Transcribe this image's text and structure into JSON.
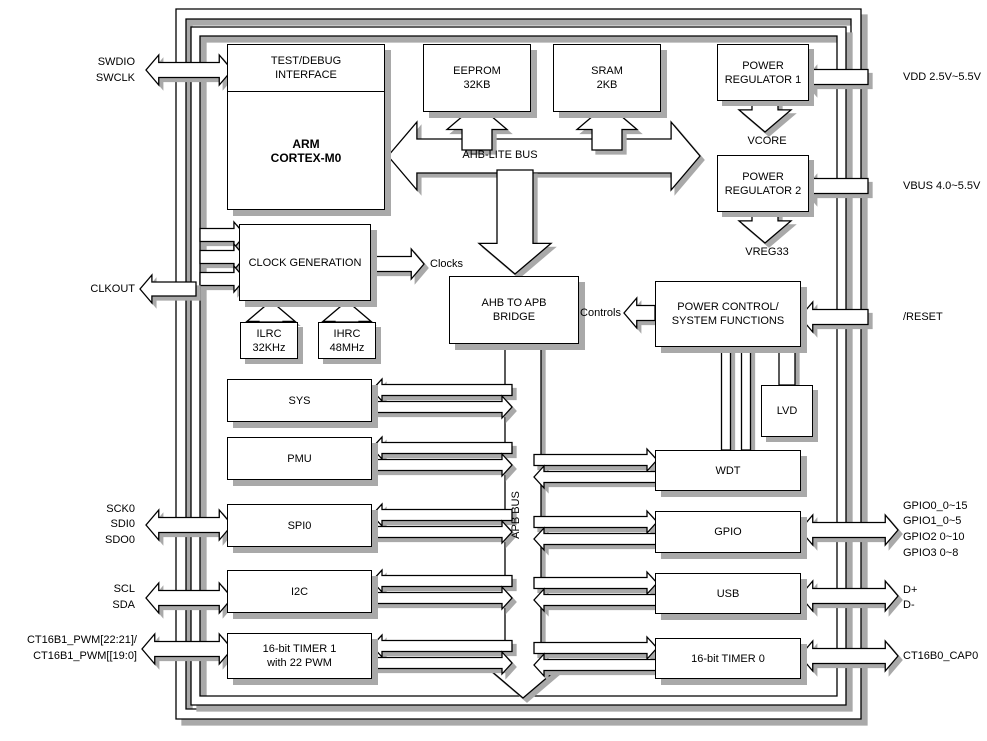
{
  "chip": {
    "blocks": {
      "test_debug": "TEST/DEBUG\nINTERFACE",
      "arm_core": "ARM\nCORTEX-M0",
      "eeprom": "EEPROM\n32KB",
      "sram": "SRAM\n2KB",
      "power_regulator_1": "POWER\nREGULATOR 1",
      "power_regulator_2": "POWER\nREGULATOR 2",
      "clock_generation": "CLOCK GENERATION",
      "ilrc": "ILRC\n32KHz",
      "ihrc": "IHRC\n48MHz",
      "ahb_apb_bridge": "AHB TO APB\nBRIDGE",
      "power_control": "POWER CONTROL/\nSYSTEM FUNCTIONS",
      "lvd": "LVD",
      "sys": "SYS",
      "pmu": "PMU",
      "spi0": "SPI0",
      "i2c": "I2C",
      "timer1": "16-bit TIMER 1\nwith 22 PWM",
      "wdt": "WDT",
      "gpio": "GPIO",
      "usb": "USB",
      "timer0": "16-bit TIMER 0"
    },
    "bus_labels": {
      "ahb": "AHB-LITE BUS",
      "apb": "APB BUS",
      "clocks": "Clocks",
      "controls": "Controls",
      "vcore": "VCORE",
      "vreg33": "VREG33"
    },
    "pins": {
      "left": {
        "swdio": "SWDIO",
        "swclk": "SWCLK",
        "clkout": "CLKOUT",
        "sck0": "SCK0",
        "sdi0": "SDI0",
        "sdo0": "SDO0",
        "scl": "SCL",
        "sda": "SDA",
        "ct16b1_a": "CT16B1_PWM[22:21]/",
        "ct16b1_b": "CT16B1_PWM[[19:0]"
      },
      "right": {
        "vdd": "VDD 2.5V~5.5V",
        "vbus": "VBUS 4.0~5.5V",
        "reset": "/RESET",
        "gpio0": "GPIO0_0~15",
        "gpio1": "GPIO1_0~5",
        "gpio2": "GPIO2 0~10",
        "gpio3": "GPIO3 0~8",
        "dplus": "D+",
        "dminus": "D-",
        "cap0": "CT16B0_CAP0"
      }
    },
    "colors": {
      "line": "#000000",
      "fill": "#ffffff",
      "shadow": "#a9a9a9"
    }
  }
}
